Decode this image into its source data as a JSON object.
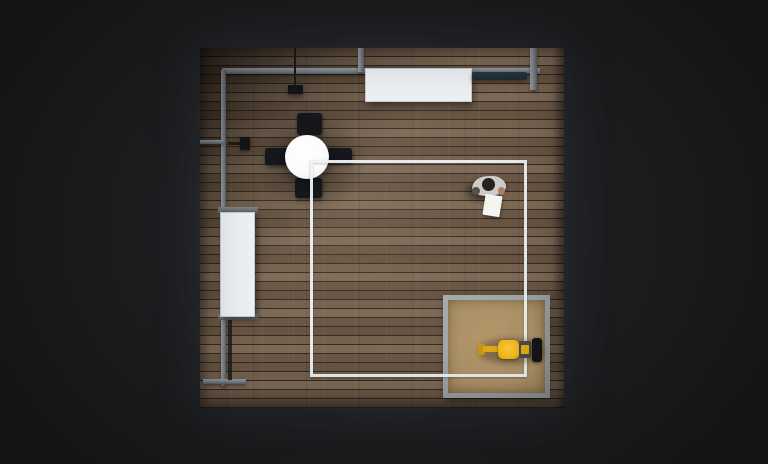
{
  "scene": {
    "title": "top-down-room-simulation-render",
    "viewport": {
      "width": 768,
      "height": 464
    },
    "objects": [
      {
        "name": "wood-floor-room",
        "note": "square room with plank wood floor, dark shadow in top-left corner"
      },
      {
        "name": "ceiling-rail-frame",
        "note": "gray rail along top and left walls with two vertical connectors and wall brackets"
      },
      {
        "name": "pendant-lamp",
        "note": "black fixture hanging from top rail"
      },
      {
        "name": "wall-device",
        "note": "small black box mounted on left rail bracket"
      },
      {
        "name": "rectangular-table-top",
        "note": "white table against top wall"
      },
      {
        "name": "teal-bench",
        "note": "thin dark teal bar near top-right wall"
      },
      {
        "name": "rectangular-table-left",
        "note": "white table against left wall with gray end caps"
      },
      {
        "name": "round-dining-table",
        "note": "white round table with four black chairs in a cross layout"
      },
      {
        "name": "floor-marker-square",
        "note": "white square outline painted on floor"
      },
      {
        "name": "sand-pad",
        "note": "tan square pad with gray concrete border in bottom-right"
      },
      {
        "name": "yellow-robot-loader",
        "note": "small yellow wheel-loader robot with black rear unit on the sand pad"
      },
      {
        "name": "person-top-view",
        "note": "person in light shirt holding a white tablet near the marker square"
      }
    ]
  },
  "colors": {
    "bg_dark": "#141516",
    "bg_mid": "#1c1d1f",
    "bg_glow": "#27292c",
    "floor_a": "#75614e",
    "floor_b": "#6b5745",
    "floor_c": "#7e6955",
    "floor_d": "#685441",
    "floor_sep": "#55453655",
    "rail": "#7e858b",
    "rail_hi": "#959ca1",
    "rail_dark": "#5a6066",
    "table_white": "#eef1f3",
    "table_edge": "#c7cbcf",
    "bench_teal": "#1e2c34",
    "chair_black": "#15171a",
    "round_table": "#fbfbfb",
    "marker_white": "#edf3f5",
    "pad_border": "#9ba1a4",
    "pad_sand": "#ab9166",
    "robot_yellow": "#f2b71d",
    "robot_yellow_dark": "#e0a816",
    "robot_black": "#141518",
    "person_shirt": "#cbcccb",
    "person_head": "#2a211b",
    "person_skin": "#a97f63",
    "tablet_white": "#f4f4f1",
    "pipe_black": "#1b1c1e"
  }
}
